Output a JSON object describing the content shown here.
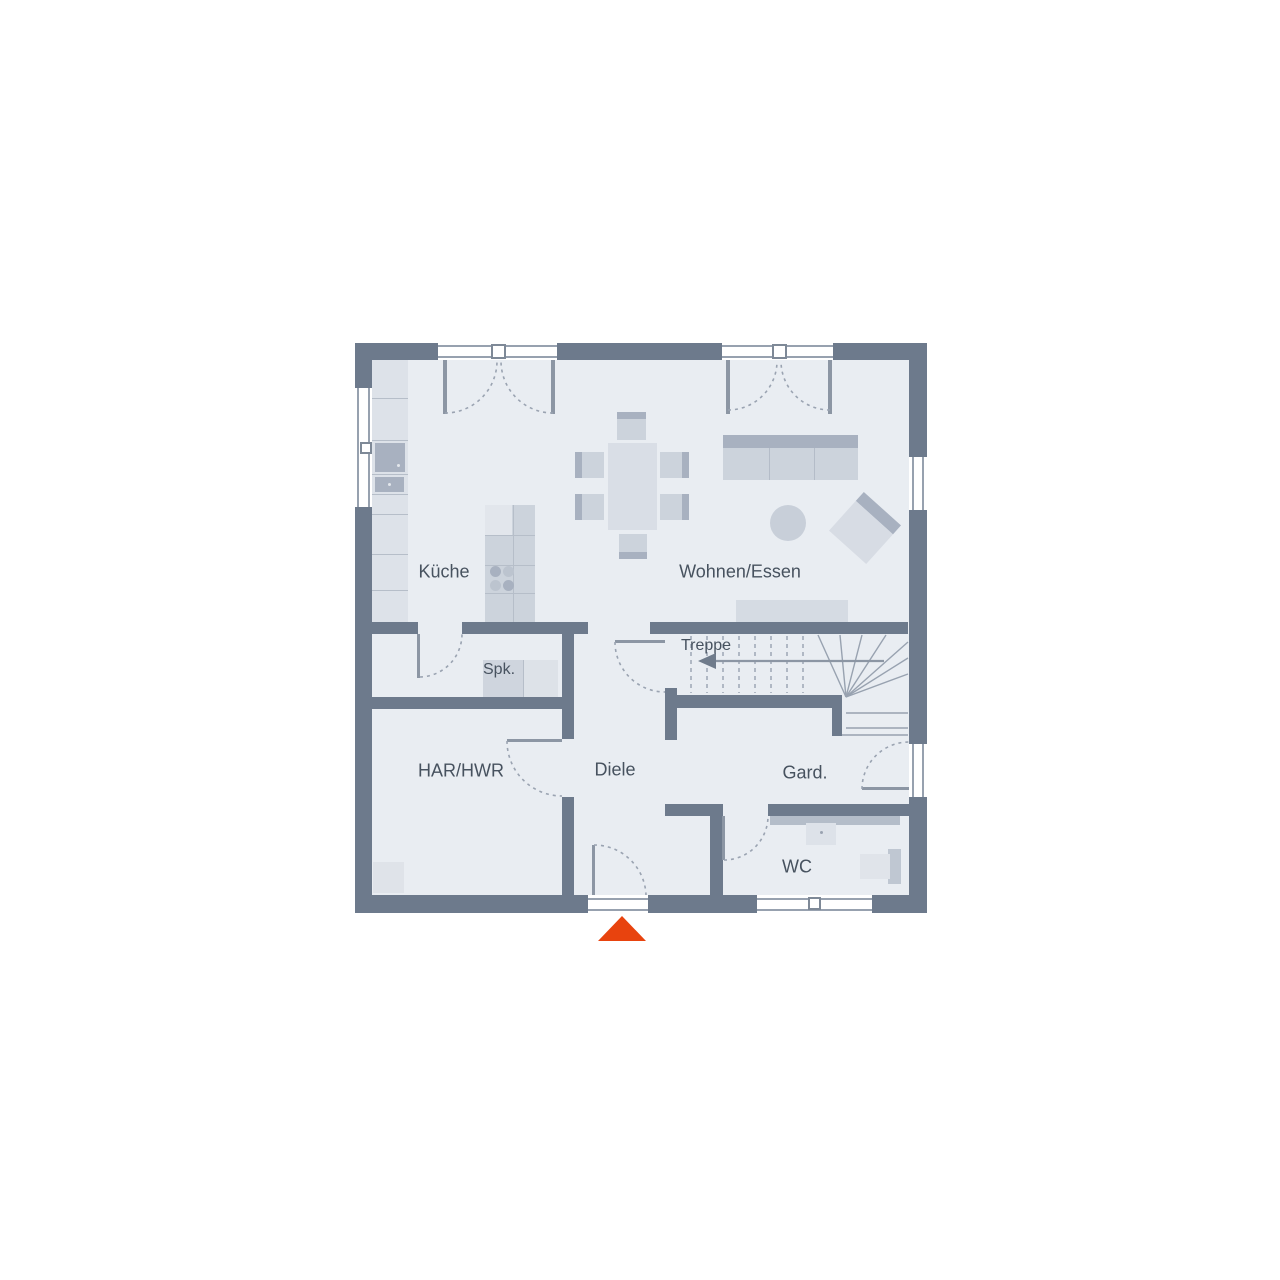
{
  "floorplan": {
    "rooms": {
      "kueche": "Küche",
      "wohnen_essen": "Wohnen/Essen",
      "spk": "Spk.",
      "treppe": "Treppe",
      "har_hwr": "HAR/HWR",
      "diele": "Diele",
      "gard": "Gard.",
      "wc": "WC"
    },
    "markers": {
      "entrance_marker": "entrance-triangle",
      "stair_direction": "arrow-left"
    },
    "colors": {
      "wall": "#6d7a8c",
      "floor": "#e9edf2",
      "furniture_light": "#dde2e9",
      "furniture_mid": "#ccd3dc",
      "furniture_dark": "#a8b1c0",
      "line": "#97a1af",
      "accent_red": "#e8430e",
      "text": "#47525f"
    }
  }
}
